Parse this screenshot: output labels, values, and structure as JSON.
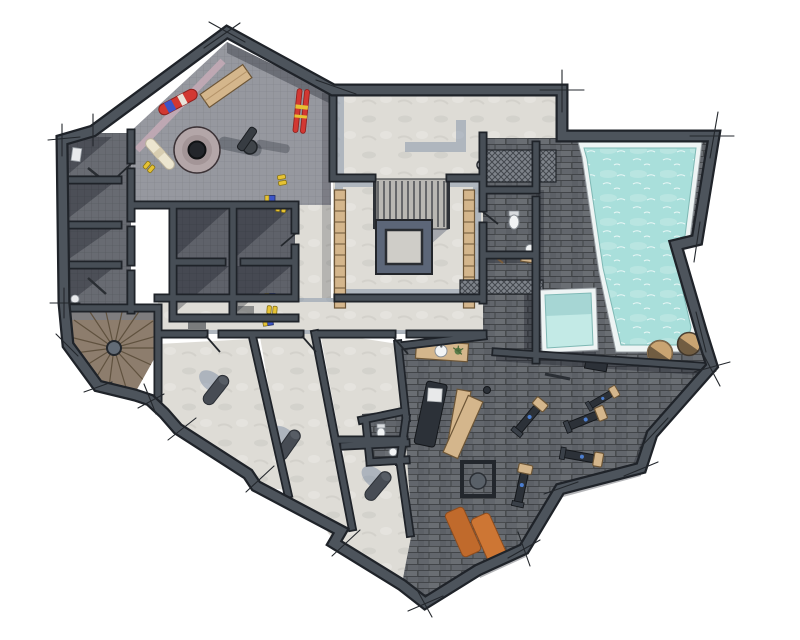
{
  "meta": {
    "kind": "architectural-floorplan-render",
    "view": "top-down-3d",
    "canvas": {
      "width": 800,
      "height": 640
    },
    "background": "#ffffff",
    "visible_text": []
  },
  "colors": {
    "wall": "#4d545c",
    "wallInner": "#474e56",
    "wallOutline": "#1f2329",
    "edge": "#1c2025",
    "tick": "#23272c",
    "floorSki": "#96989f",
    "floorStorage": "#5f626a",
    "floorCellar": "#686b72",
    "floorLight": "#dedcd6",
    "tileDark": "#62666c",
    "railBase": "#7e838a",
    "water": "#a9dfdb",
    "waterLight": "#c3eae6",
    "rim": "#eef4f4",
    "wood": "#d4b68c",
    "woodDark": "#6d5637",
    "stairWood": "#8d7d6d",
    "stairLine": "#60523f",
    "concreteMid": "#b9b8b3",
    "openingBlue": "#5c6678",
    "openingInner": "#cfcdc8",
    "shadowDark": "rgba(18,22,30,0.32)",
    "shadowBlue": "rgba(104,124,155,0.40)",
    "mauve": "#c3aab6",
    "orange": "#c06a2c",
    "orange2": "#cd7634",
    "red": "#d23832",
    "blue": "#3c55c8",
    "yellow": "#e6c233",
    "cream": "#ece5cf",
    "green": "#5c7d4a",
    "equip": "#2c3138",
    "equipOutline": "#14171b",
    "porcelain": "#f2f4f5",
    "barrel": "#c9a472"
  },
  "rooms": [
    {
      "id": "ski-room",
      "purpose": "ski-and-boot-room",
      "floor": "gray-tile-grid"
    },
    {
      "id": "cellar-left-1",
      "purpose": "cellar",
      "floor": "dark-gray"
    },
    {
      "id": "cellar-left-2",
      "purpose": "cellar",
      "floor": "dark-gray"
    },
    {
      "id": "cellar-left-3",
      "purpose": "cellar",
      "floor": "dark-gray"
    },
    {
      "id": "storage-1",
      "purpose": "storage-box",
      "floor": "dark-gray-grid"
    },
    {
      "id": "storage-2",
      "purpose": "storage-box",
      "floor": "dark-gray-grid"
    },
    {
      "id": "storage-3",
      "purpose": "storage-box",
      "floor": "dark-gray-grid"
    },
    {
      "id": "storage-4",
      "purpose": "storage-box",
      "floor": "dark-gray-grid"
    },
    {
      "id": "spiral-stair-room",
      "purpose": "winder-staircase",
      "floor": "wood"
    },
    {
      "id": "plant-room",
      "purpose": "technical-room",
      "floor": "concrete"
    },
    {
      "id": "stair-hall",
      "purpose": "staircase-hall-with-void",
      "floor": "concrete"
    },
    {
      "id": "corridor",
      "purpose": "corridor",
      "floor": "concrete"
    },
    {
      "id": "wc",
      "purpose": "toilet-room",
      "floor": "dark-tile"
    },
    {
      "id": "pool-hall",
      "purpose": "swimming-pool",
      "floor": "dark-tile"
    },
    {
      "id": "plunge-pool",
      "purpose": "plunge-pool",
      "floor": "water"
    },
    {
      "id": "massage-room",
      "purpose": "treatment-room",
      "floor": "dark-tile"
    },
    {
      "id": "wc-2",
      "purpose": "toilet-room",
      "floor": "dark-tile"
    },
    {
      "id": "gym",
      "purpose": "fitness-room",
      "floor": "dark-tile"
    },
    {
      "id": "bedroom-a",
      "purpose": "unfurnished-room",
      "floor": "concrete"
    },
    {
      "id": "bedroom-b",
      "purpose": "unfurnished-room",
      "floor": "concrete"
    },
    {
      "id": "bedroom-c",
      "purpose": "unfurnished-room",
      "floor": "concrete"
    },
    {
      "id": "bedroom-d",
      "purpose": "unfurnished-room",
      "floor": "concrete"
    }
  ],
  "fixtures": {
    "ski_room": [
      "snowboard-red-blue",
      "snowboard-cream",
      "ski-pair-red",
      "wood-bench",
      "round-floor-drain",
      "column",
      "boot-pairs-yellow",
      "gear-boxes-blue-yellow"
    ],
    "stair_hall": [
      "straight-stair-flight",
      "floor-opening",
      "wood-step-strips"
    ],
    "spa": [
      "toilet",
      "round-sink",
      "wall-clock",
      "railing-grate",
      "wood-mat",
      "broom"
    ],
    "pool_area": [
      "main-pool",
      "plunge-pool",
      "wood-barrel-tubs"
    ],
    "massage_room": [
      "massage-table",
      "wood-bench",
      "vanity-sink",
      "plant"
    ],
    "gym": [
      "exercise-machines",
      "squat-rack",
      "yoga-mats-orange",
      "wood-plank",
      "dumbbells"
    ],
    "bedrooms": [
      "rolled-cylinder-objects",
      "door-leaves"
    ],
    "spiral_room": [
      "winder-stair-treads",
      "center-post"
    ]
  },
  "counts": {
    "exercise_machines": 5,
    "yoga_mats": 2,
    "barrel_tubs": 2,
    "cylinders": 3,
    "boot_pairs": 4
  }
}
